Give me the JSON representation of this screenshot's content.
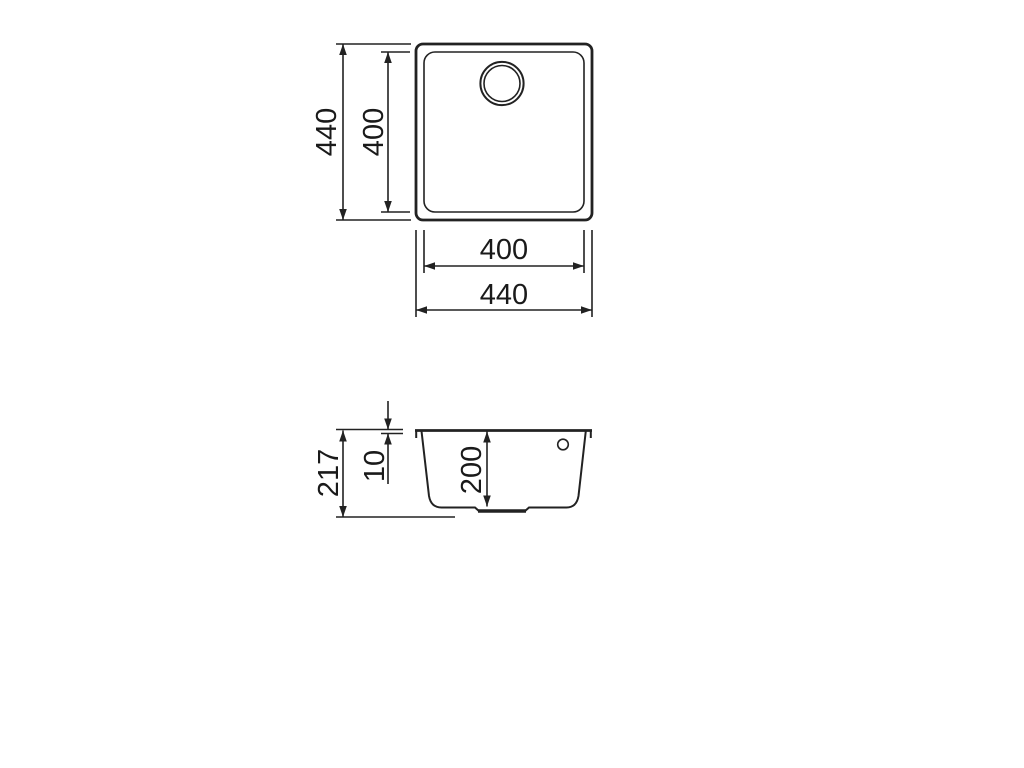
{
  "colors": {
    "line": "#222222",
    "text": "#1a1a1a",
    "background": "#ffffff"
  },
  "top_view": {
    "outer_height_mm": "440",
    "inner_height_mm": "400",
    "inner_width_mm": "400",
    "outer_width_mm": "440"
  },
  "section_view": {
    "total_height_mm": "217",
    "rim_height_mm": "10",
    "bowl_depth_mm": "200"
  }
}
